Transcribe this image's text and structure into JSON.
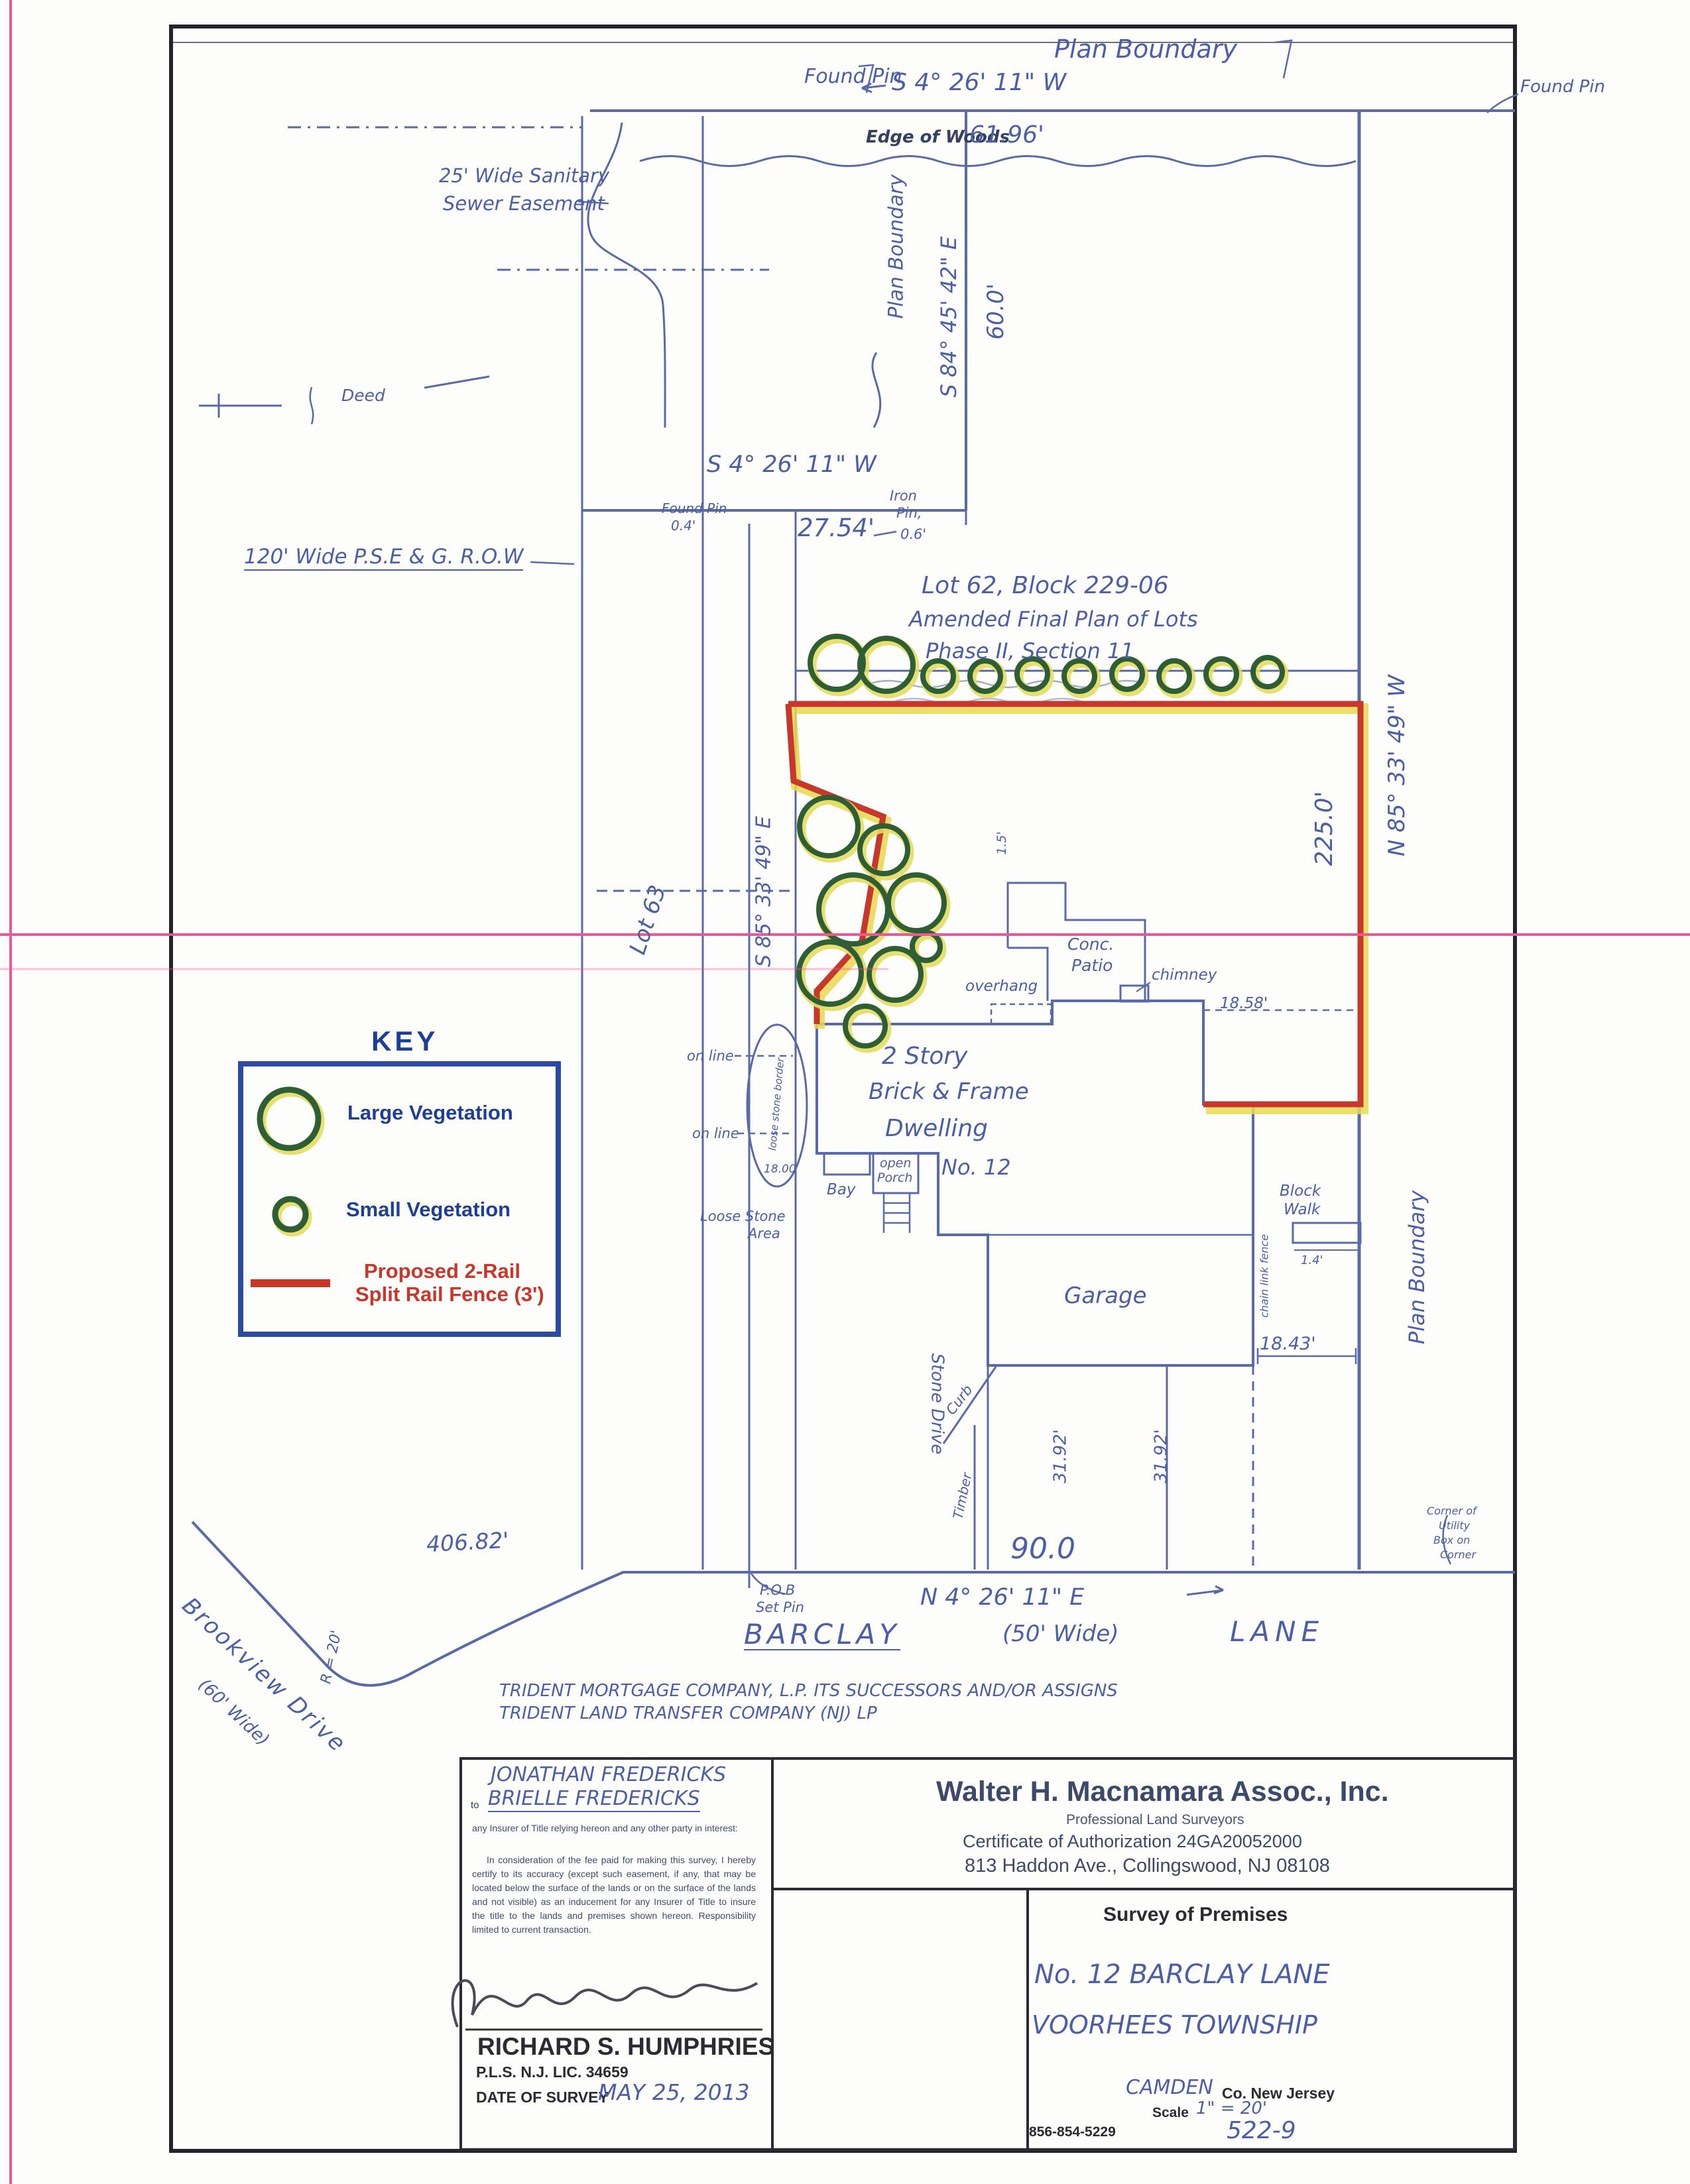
{
  "top": {
    "found_pin_left": "Found Pin",
    "plan_boundary": "Plan Boundary",
    "bearing": "S 4° 26' 11\" W",
    "found_pin_right": "Found Pin",
    "edge_of_woods": "Edge of Woods",
    "woods_length": "61.96'"
  },
  "easement": {
    "line1": "25' Wide Sanitary",
    "line2": "Sewer Easement",
    "deed": "Deed",
    "row": "120' Wide P.S.E & G. R.O.W"
  },
  "corridor": {
    "plan_boundary": "Plan Boundary",
    "bearing": "S 84° 45' 42\" E",
    "length": "60.0'"
  },
  "mid": {
    "bearing": "S 4° 26' 11\" W",
    "found_pin": "Found Pin",
    "pin_offset": "0.4'",
    "distance": "27.54'",
    "iron1": "Iron",
    "iron2": "Pin,",
    "iron3": "0.6'"
  },
  "lot62": {
    "line1": "Lot 62,  Block 229-06",
    "line2": "Amended Final Plan of Lots",
    "line3": "Phase II,  Section 11"
  },
  "east": {
    "bearing": "N 85° 33' 49\" W",
    "length": "225.0'",
    "plan_boundary": "Plan Boundary",
    "corner1": "Corner of",
    "corner2": "Utility",
    "corner3": "Box on",
    "corner4": "Corner"
  },
  "west": {
    "lot63": "Lot 63",
    "bearing": "S 85° 33' 49\" E",
    "on_line1": "on line",
    "on_line2": "on line",
    "loose_border": "loose stone border",
    "loose_area1": "Loose Stone",
    "loose_area2": "Area",
    "dim_1800": "18.00"
  },
  "house": {
    "line1": "2 Story",
    "line2": "Brick & Frame",
    "line3": "Dwelling",
    "number": "No. 12",
    "conc": "Conc.",
    "patio": "Patio",
    "chimney": "chimney",
    "overhang": "overhang",
    "offset15": "1.5'",
    "dim_1858": "18.58'",
    "bay": "Bay",
    "porch1": "open",
    "porch2": "Porch",
    "garage": "Garage",
    "walk1": "Block",
    "walk2": "Walk",
    "walk_offset": "1.4'",
    "dim_1843": "18.43'",
    "fence": "chain link fence",
    "drive": "Stone Drive",
    "dim_3192a": "31.92'",
    "dim_3192b": "31.92'",
    "curb": "Curb",
    "timber": "Timber"
  },
  "street": {
    "pob1": "P.O.B",
    "pob2": "Set Pin",
    "frontage": "90.0",
    "bearing": "N 4° 26' 11\" E",
    "name1": "BARCLAY",
    "name2": "(50' Wide)",
    "name3": "LANE",
    "length": "406.82'",
    "radius": "R = 20'",
    "brookview": "Brookview Drive",
    "brookview_width": "(60' Wide)"
  },
  "owners": {
    "line1": "TRIDENT MORTGAGE COMPANY, L.P.   ITS SUCCESSORS AND/OR ASSIGNS",
    "line2": "TRIDENT LAND TRANSFER COMPANY (NJ) LP"
  },
  "key": {
    "title": "KEY",
    "large": "Large Vegetation",
    "small": "Small Vegetation",
    "fence1": "Proposed 2-Rail",
    "fence2": "Split Rail Fence (3')"
  },
  "title_block": {
    "client1": "JONATHAN FREDERICKS",
    "to": "to",
    "client2": "BRIELLE FREDERICKS",
    "cert1": "any Insurer of Title relying hereon and any other party in interest:",
    "cert2": "In consideration of the fee paid for making this survey, I hereby certify to its accuracy (except such easement, if any, that may be located below the surface of the lands or on the surface of the lands and not visible) as an inducement for any Insurer of Title to insure the title to the lands and premises shown hereon. Responsibility limited to current transaction.",
    "surveyor": "RICHARD S. HUMPHRIES",
    "license": "P.L.S. N.J. LIC. 34659",
    "date_label": "DATE OF SURVEY",
    "date_value": "MAY 25, 2013",
    "firm": "Walter H. Macnamara Assoc., Inc.",
    "firm_sub": "Professional Land Surveyors",
    "firm_cert": "Certificate of Authorization 24GA20052000",
    "firm_addr": "813 Haddon Ave., Collingswood, NJ 08108",
    "survey_of": "Survey of Premises",
    "premises1": "No. 12  BARCLAY  LANE",
    "premises2": "VOORHEES  TOWNSHIP",
    "county": "CAMDEN",
    "county_print": "Co. New Jersey",
    "scale_label": "Scale",
    "scale_value": "1\" = 20'",
    "job_no": "522-9",
    "phone": "856-854-5229"
  }
}
